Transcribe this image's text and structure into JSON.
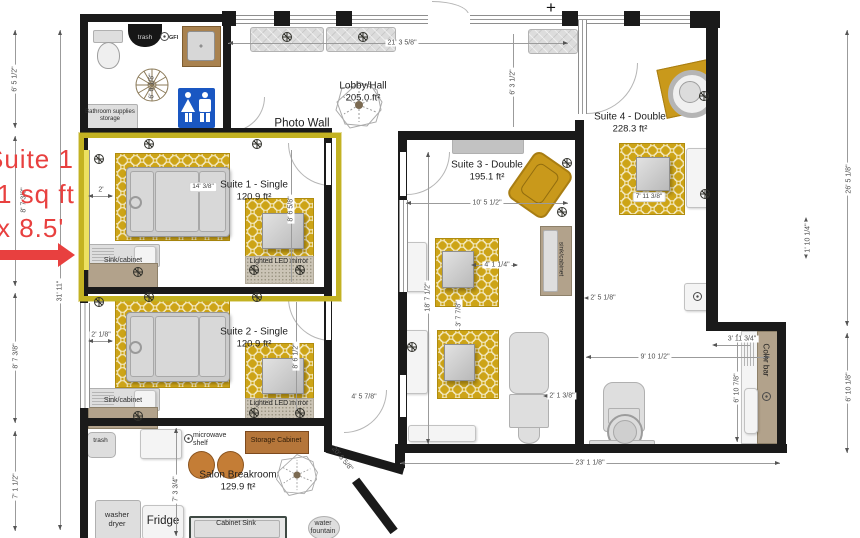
{
  "annotation": {
    "line1": "Suite 1",
    "line2": "1 sq ft",
    "line3": "x 8.5'"
  },
  "markers": {
    "plus": "+"
  },
  "rooms": {
    "lobby": {
      "name": "Lobby/Hall",
      "area": "205.0 ft²"
    },
    "photo_wall": "Photo Wall",
    "suite1": {
      "name": "Suite 1 - Single",
      "area": "120.9 ft²"
    },
    "suite2": {
      "name": "Suite 2 - Single",
      "area": "120.9 ft²"
    },
    "suite3": {
      "name": "Suite 3 - Double",
      "area": "195.1 ft²"
    },
    "suite4": {
      "name": "Suite 4 - Double",
      "area": "228.3 ft²"
    },
    "breakroom": {
      "name": "Salon Breakroom",
      "area": "129.9 ft²"
    }
  },
  "fixtures": {
    "bathroom_trash": "trash",
    "gfi": "GFI",
    "bathroom_storage": "Bathroom supplies storage",
    "suite1_sink": "Sink/cabinet",
    "suite1_mirror": "Lighted LED mirror",
    "suite2_sink": "Sink/cabinet",
    "suite2_mirror": "Lighted LED mirror",
    "suite3_sink": "sink/cabinet",
    "color_bar": "Color bar",
    "breakroom_trash": "trash",
    "microwave_shelf": "microwave shelf",
    "storage_cabinet": "Storage Cabinet",
    "washer_dryer": "washer dryer",
    "fridge": "Fridge",
    "cabinet_sink": "Cabinet Sink",
    "water_fountain": "water fountain"
  },
  "dimensions": {
    "top_width": "21' 3 5/8\"",
    "lobby_depth": "6' 3 1/2\"",
    "left_bathroom": "6' 5 1/2\"",
    "left_suite1": "8' 7 3/8\"",
    "left_suite2": "8' 7 3/8\"",
    "left_breakroom": "7' 1 1/2\"",
    "left_total": "31' 11\"",
    "right_upper": "26' 5 1/8\"",
    "right_lower": "6' 10 1/8\"",
    "right_offset": "1' 10 1/4\"",
    "bottom_width": "23' 1 1/8\"",
    "bathroom_ceiling": "6' 6 1/8\"",
    "suite1_bed": "14' 3/8\"",
    "suite1_gap": "2'",
    "suite1_depth": "8' 6 5/8\"",
    "suite2_gap": "2' 1/8\"",
    "suite2_depth": "8' 6 1/2\"",
    "suite3_width": "10' 5 1/2\"",
    "suite3_depth": "18' 7 1/2\"",
    "suite3_rug": "4' 1 1/4\"",
    "suite3_gap": "3' 7 7/8\"",
    "suite3_bed": "2' 1 3/8\"",
    "suite3_door": "4' 5 7/8\"",
    "angled_wall": "20' 6 5/8\"",
    "suite4_rug": "7' 11 3/8\"",
    "suite4_gap": "2' 5 1/8\"",
    "suite4_width": "9' 10 1/2\"",
    "colorbar_width": "3' 11 3/4\"",
    "colorbar_depth": "6' 10 7/8\"",
    "breakroom_depth": "7' 3 3/4\""
  },
  "colors": {
    "selection": "#c3b222",
    "rug_gold": "#cda417",
    "annotation_red": "#e8403f",
    "wall": "#1a1a1a",
    "sign_blue": "#1a57c2",
    "cabinet_orange": "#b5763a"
  }
}
